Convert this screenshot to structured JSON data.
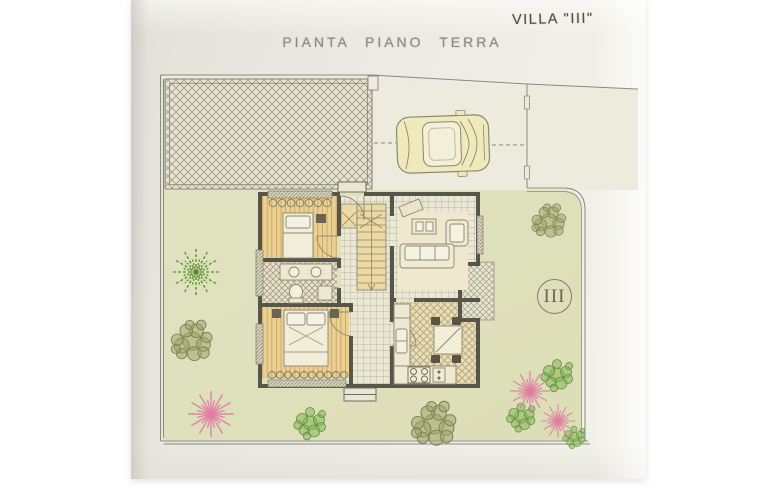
{
  "header": {
    "villa_label": "VILLA \"III\"",
    "title": "PIANTA PIANO TERRA"
  },
  "plan": {
    "unit_badge": "III"
  },
  "colors": {
    "page": "#ffffff",
    "photo_bg": "#eceade",
    "drawing_paper": "#edebdd",
    "line": "#8b8979",
    "wall": "#57564b",
    "garden_green": "#dfe0bd",
    "wood_floor": "#ecd092",
    "stair_wood": "#ecd9a4",
    "hall_tile": "#eae7d5",
    "kitchen_tile": "#e9ddb6",
    "terrace_hatch": "#e7e4d3",
    "car_body": "#efe9bc",
    "palm_green": "#6aa23c",
    "olive_green": "#8f9762",
    "leaf_green": "#86b55a",
    "flower_pink": "#df7da3",
    "title_text": "#8d8b7d",
    "label_text": "#4f4f48"
  }
}
